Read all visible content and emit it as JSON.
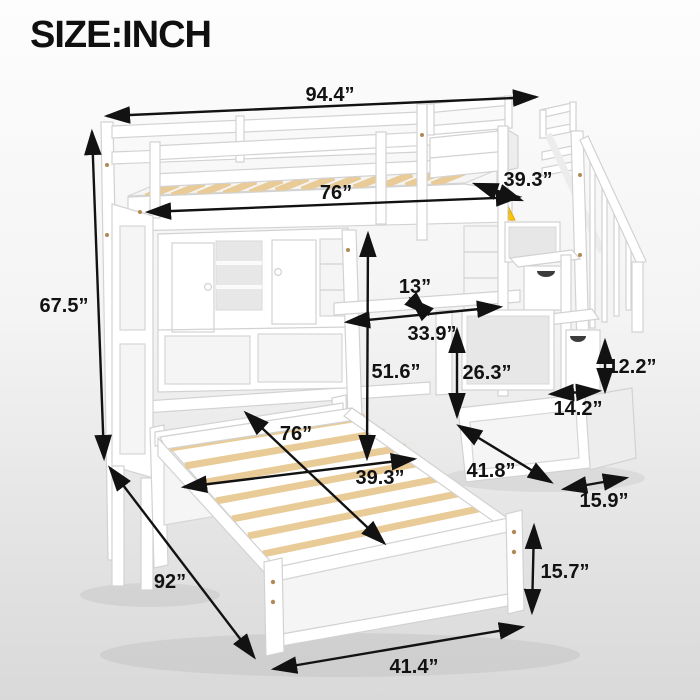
{
  "title": "SIZE:INCH",
  "icons": {
    "warning_glyph": "!"
  },
  "colors": {
    "background_top": "#fdfdfd",
    "background_bottom": "#d9d9d9",
    "text": "#121212",
    "arrow": "#121212",
    "furniture_white": "#ffffff",
    "furniture_stroke": "#d2d2d2",
    "slat_wood": "#e8cb97",
    "warning_yellow": "#ffc400"
  },
  "dimensions": {
    "overall_width": "94.4”",
    "overall_height": "67.5”",
    "upper_bed_length": "76”",
    "upper_bed_width": "39.3”",
    "shelf_depth": "13”",
    "desk_width": "33.9”",
    "loft_clearance_height": "51.6”",
    "stair_storage_height": "26.3”",
    "stair_drawer_height": "12.2”",
    "stair_step_depth": "14.2”",
    "staircase_length": "41.8”",
    "staircase_width": "15.9”",
    "lower_bed_slat_length": "76”",
    "lower_bed_width": "39.3”",
    "lower_bed_length": "92”",
    "footboard_width": "41.4”",
    "footboard_height": "15.7”"
  }
}
